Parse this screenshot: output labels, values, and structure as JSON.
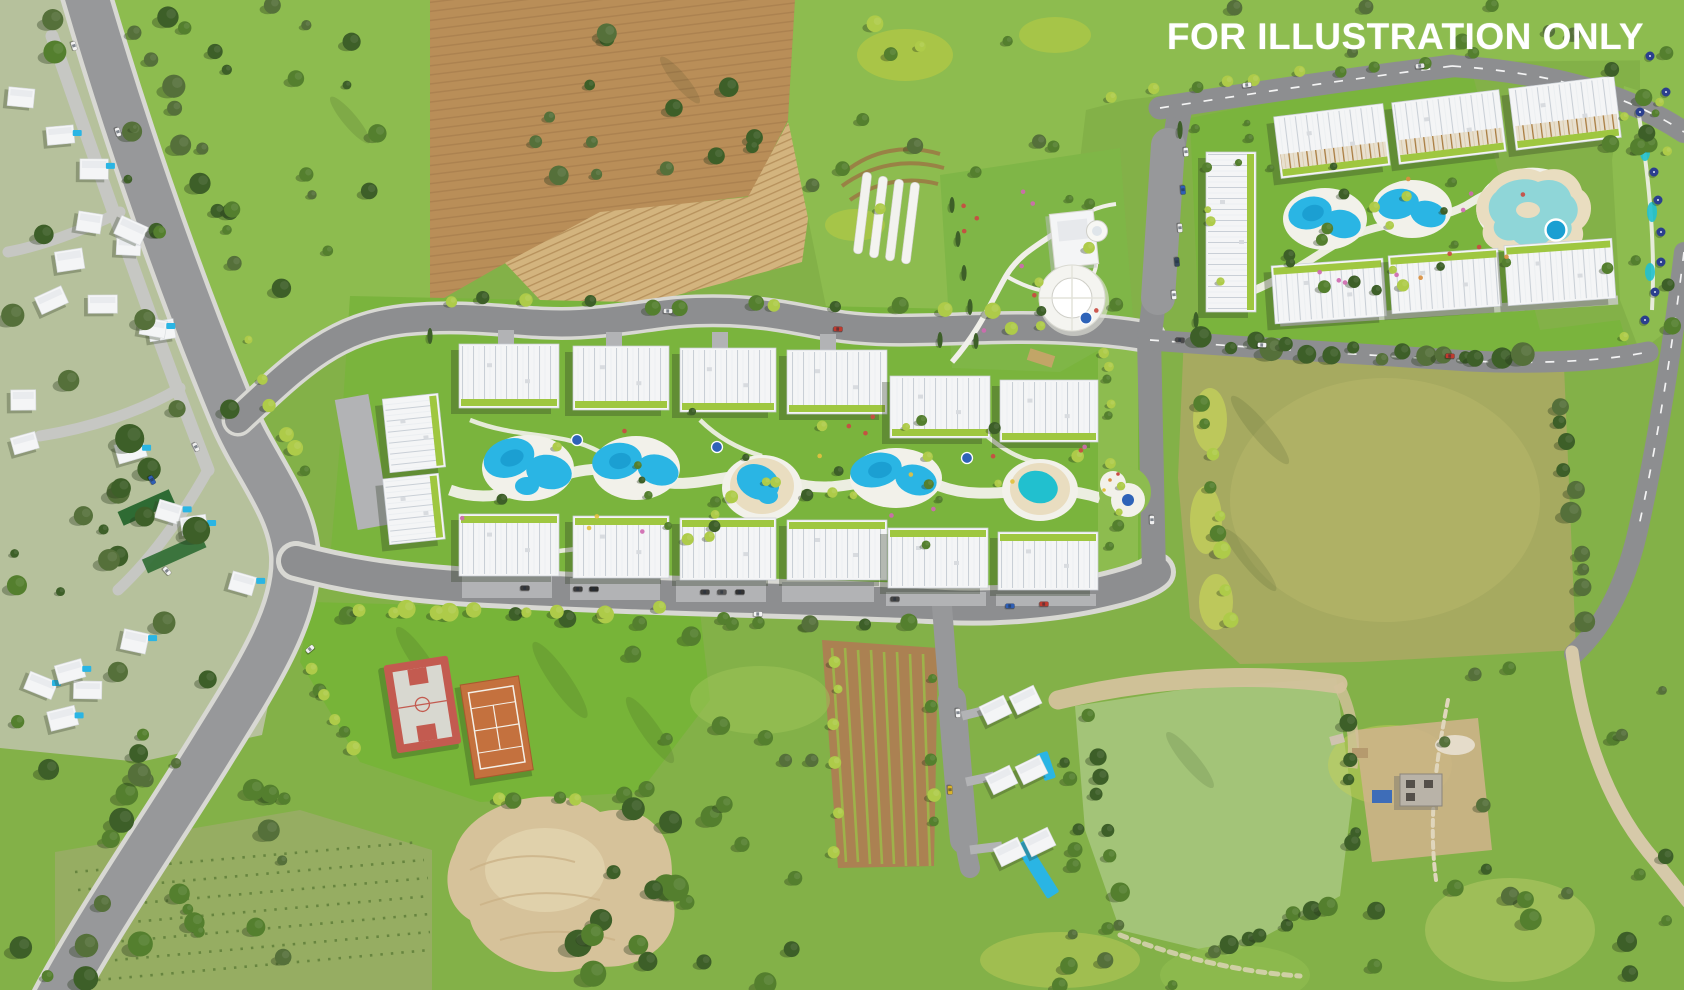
{
  "watermark": {
    "text": "FOR ILLUSTRATION ONLY",
    "color": "#ffffff"
  },
  "scene": {
    "kind": "aerial-masterplan-render",
    "areas": [
      "existing-villa-neighborhood",
      "main-road",
      "phase-1-apartment-resort",
      "phase-2-apartment-resort",
      "clubhouse-park",
      "sports-courts",
      "detached-villas-cluster",
      "farmland",
      "olive-meadow",
      "pasture-field"
    ]
  },
  "palette": {
    "asphalt": "#97989a",
    "asphaltDark": "#8d8e90",
    "sidewalk": "#d8d8d3",
    "innerRoad": "#c6c7c3",
    "dirtRoad": "#d6c9a9",
    "grass": "#83b148",
    "grassBright": "#8dbc4f",
    "grassLawn": "#77b438",
    "grassLime": "#c3cf5a",
    "grassOlive": "#a6aa60",
    "grassPale": "#a3c478",
    "treeDark": "#3d5f28",
    "treeMid": "#547f2e",
    "treeOlive": "#55703a",
    "treeLime": "#aecb49",
    "treeShadow": "#24361b",
    "soil": "#b98e58",
    "soilLight": "#d3b47e",
    "soilDark": "#a87c49",
    "sand": "#d6c29a",
    "sandLight": "#e2d3ae",
    "building": "#f4f5f6",
    "buildingLine": "#cfd5da",
    "shadow": "#2e3b22",
    "balcony": "#9fc740",
    "deck": "#f2f1ea",
    "pool": "#2ab5e4",
    "poolDeep": "#1b9fd2",
    "poolTeal": "#21c0cf",
    "lagoon": "#8fd6d8",
    "lagoonSand": "#e9ddc0",
    "spaBlue": "#2e63b8",
    "courtRed": "#c35b50",
    "courtSurface": "#d8d8d0",
    "clay": "#c4713e",
    "umbrella": "#2b3f8e",
    "carRed": "#c03a2e",
    "carBlue": "#2f5fb5",
    "wm": "#ffffff"
  }
}
